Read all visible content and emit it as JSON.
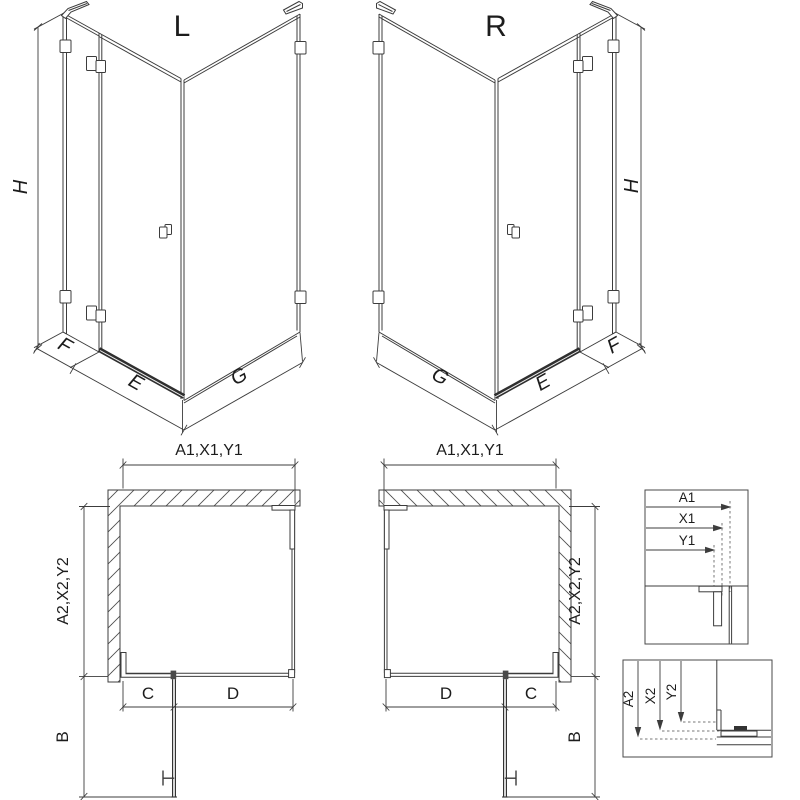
{
  "sheet": {
    "colors": {
      "background": "#ffffff",
      "line": "#3c3c3c",
      "text": "#1c1c1c",
      "threshold": "#2f2f2f"
    },
    "views": {
      "iso_left": {
        "variant_label": "L",
        "height_label": "H",
        "return_panel_label": "F",
        "door_label": "E",
        "side_panel_label": "G"
      },
      "iso_right": {
        "variant_label": "R",
        "height_label": "H",
        "return_panel_label": "F",
        "door_label": "E",
        "side_panel_label": "G"
      },
      "plan_left": {
        "width_label": "A1,X1,Y1",
        "depth_label": "A2,X2,Y2",
        "fixed_segment_label": "C",
        "opening_label": "D",
        "door_projection_label": "B"
      },
      "plan_right": {
        "width_label": "A1,X1,Y1",
        "depth_label": "A2,X2,Y2",
        "fixed_segment_label": "C",
        "opening_label": "D",
        "door_projection_label": "B"
      },
      "detail_width": {
        "dim_labels": [
          "A1",
          "X1",
          "Y1"
        ]
      },
      "detail_depth": {
        "dim_labels": [
          "A2",
          "X2",
          "Y2"
        ]
      }
    }
  }
}
